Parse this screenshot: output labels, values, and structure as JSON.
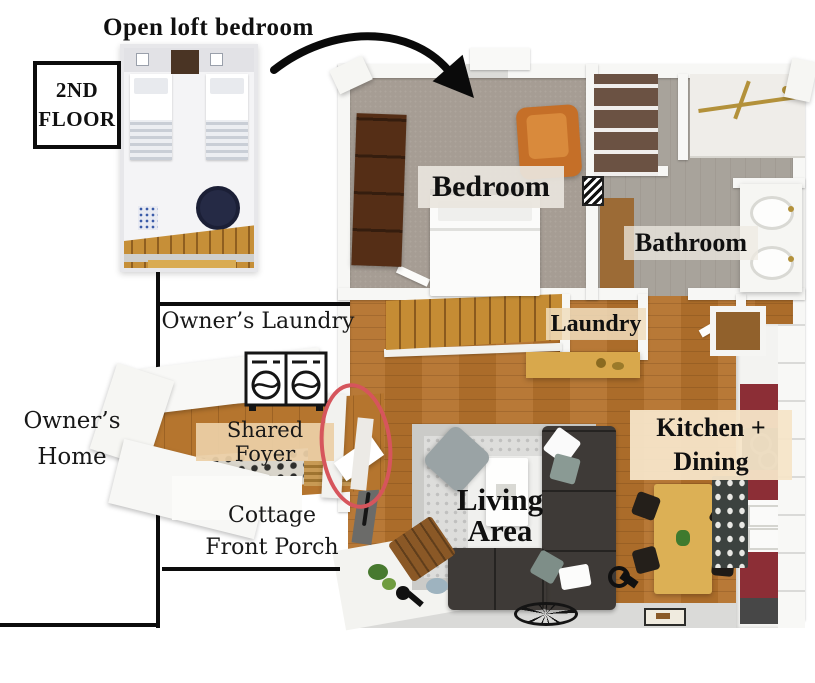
{
  "page": {
    "background": "#ffffff"
  },
  "titles": {
    "loft": "Open loft bedroom",
    "floor_badge_line1": "2ND",
    "floor_badge_line2": "FLOOR"
  },
  "left_labels": {
    "owners_laundry": "Owner’s Laundry",
    "owners_home_line1": "Owner’s",
    "owners_home_line2": "Home",
    "shared_foyer": "Shared Foyer",
    "cottage_porch_line1": "Cottage",
    "cottage_porch_line2": "Front Porch"
  },
  "room_labels": {
    "bedroom": "Bedroom",
    "bathroom": "Bathroom",
    "laundry": "Laundry",
    "kitchen_line1": "Kitchen +",
    "kitchen_line2": "Dining",
    "living_line1": "Living",
    "living_line2": "Area"
  },
  "icons": {
    "curved_arrow": "curved-arrow-icon",
    "washer_dryer": "washer-dryer-icon",
    "door_highlight": "red-oval-highlight-icon",
    "wall_clock": "wall-clock-icon"
  },
  "colors": {
    "annotation_black": "#0c0c0c",
    "highlight_red": "#d6555c",
    "wood_floor": "#b4722c",
    "stair_wood": "#c58c34",
    "bedroom_carpet": "#a69d94",
    "bathroom_tile": "#a19b93",
    "kitchen_accent_red": "#8c2e36",
    "sofa_charcoal": "#3e3a37",
    "armchair_orange": "#c56f28",
    "ottoman_navy": "#252a45",
    "label_tan": "#f0ddbd",
    "rug_gray": "#dddddb"
  }
}
